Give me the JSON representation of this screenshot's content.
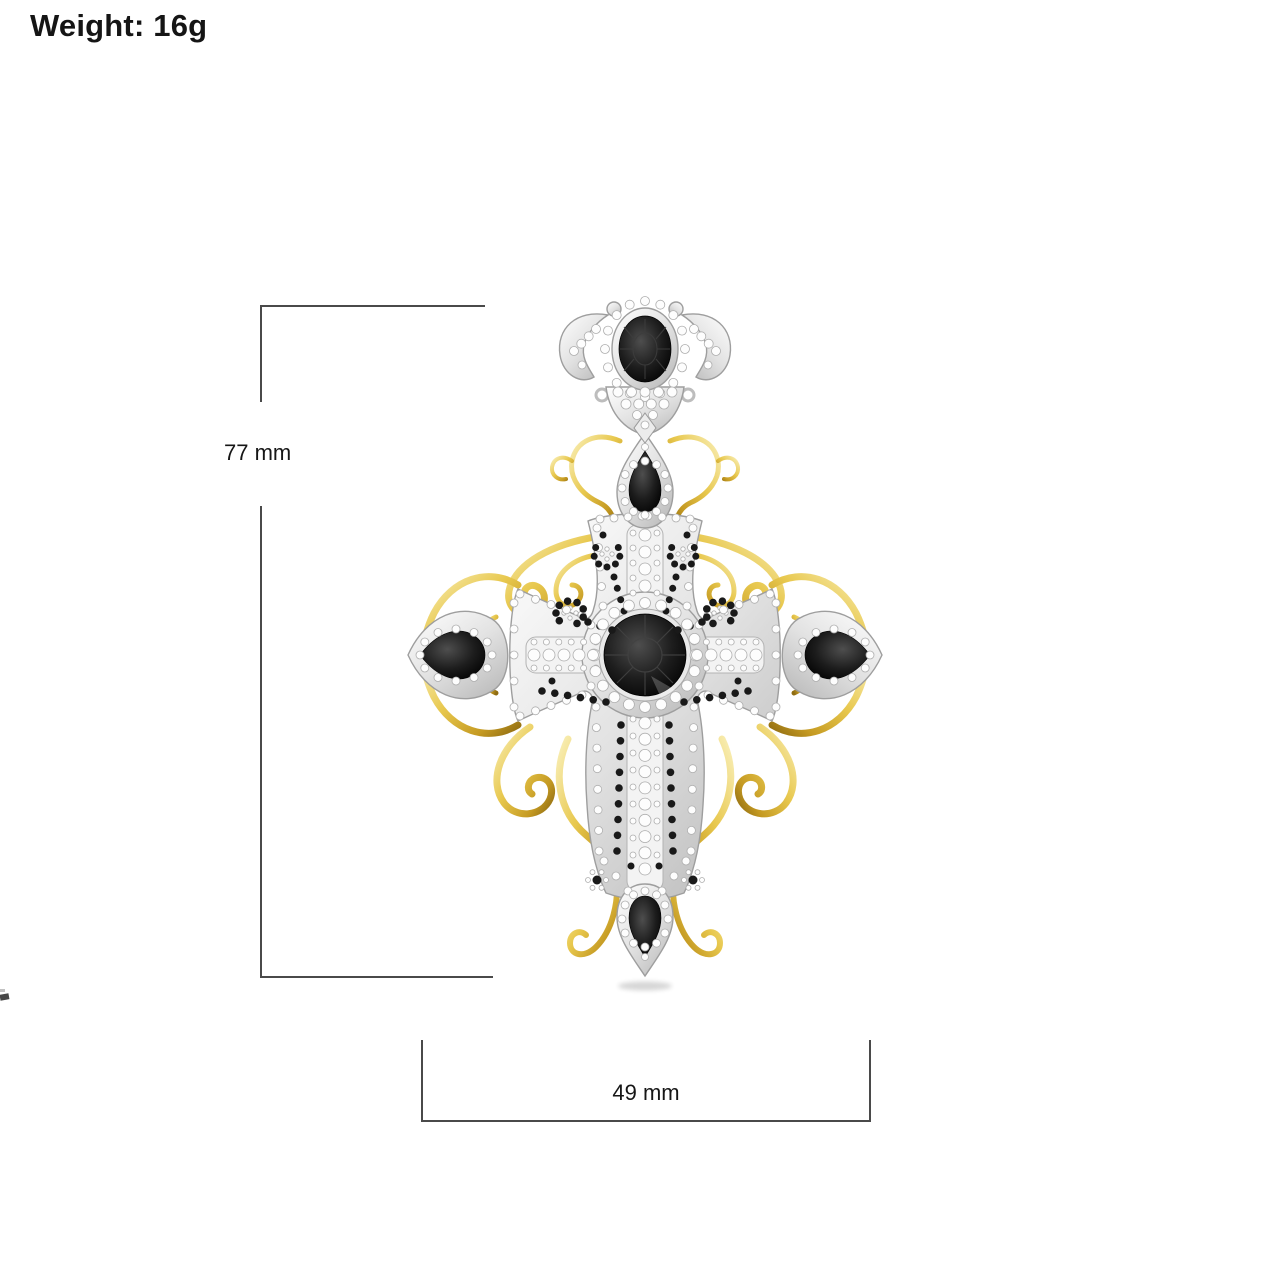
{
  "header": {
    "weight_label": "Weight: 16g"
  },
  "dimensions": {
    "height_label": "77 mm",
    "width_label": "49 mm"
  },
  "pendant": {
    "description_name": "ornate-cross-pendant",
    "materials": {
      "metal_primary": "yellow-gold-filigree",
      "metal_secondary": "white-gold-pave",
      "stones": "black-gems-and-white-diamonds"
    }
  },
  "colors": {
    "gold": "#e2c04a",
    "gold_deep": "#b08a1e",
    "silver": "#d9d9d9",
    "gem_black": "#101010",
    "dimension_line": "#4a4a4a",
    "background": "#ffffff"
  }
}
